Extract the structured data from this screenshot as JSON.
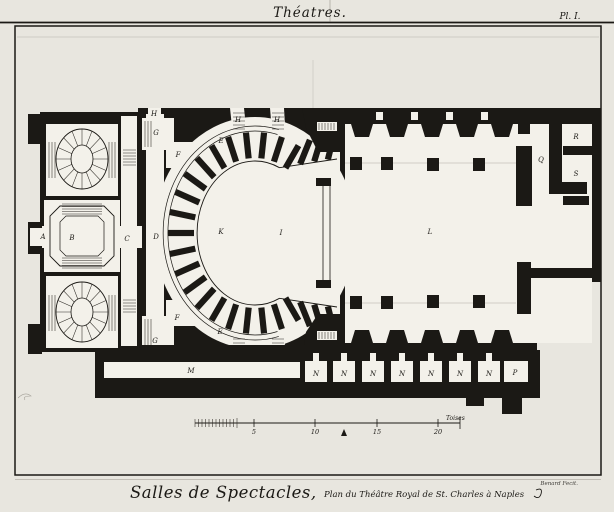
{
  "plate": {
    "header_title": "Théatres.",
    "plate_number": "Pl. I.",
    "caption_script": "Salles de Spectacles,",
    "caption_detail": "Plan du Théâtre Royal de St. Charles à Naples",
    "engraver_credit": "Benard Fecit."
  },
  "scale_bar": {
    "tick_labels": [
      "5",
      "10",
      "15",
      "20"
    ],
    "unit_label": "Toises"
  },
  "plan_labels": [
    {
      "text": "A"
    },
    {
      "text": "B"
    },
    {
      "text": "C"
    },
    {
      "text": "D"
    },
    {
      "text": "E"
    },
    {
      "text": "F"
    },
    {
      "text": "G"
    },
    {
      "text": "H"
    },
    {
      "text": "H"
    },
    {
      "text": "H"
    },
    {
      "text": "E"
    },
    {
      "text": "F"
    },
    {
      "text": "G"
    },
    {
      "text": "K"
    },
    {
      "text": "I"
    },
    {
      "text": "L"
    },
    {
      "text": "M"
    },
    {
      "text": "N"
    },
    {
      "text": "N"
    },
    {
      "text": "N"
    },
    {
      "text": "N"
    },
    {
      "text": "N"
    },
    {
      "text": "N"
    },
    {
      "text": "N"
    },
    {
      "text": "P"
    },
    {
      "text": "Q"
    },
    {
      "text": "R"
    },
    {
      "text": "S"
    }
  ],
  "colors": {
    "paper": "#e8e6df",
    "room_white": "#f3f1ea",
    "ink": "#1b1915"
  }
}
